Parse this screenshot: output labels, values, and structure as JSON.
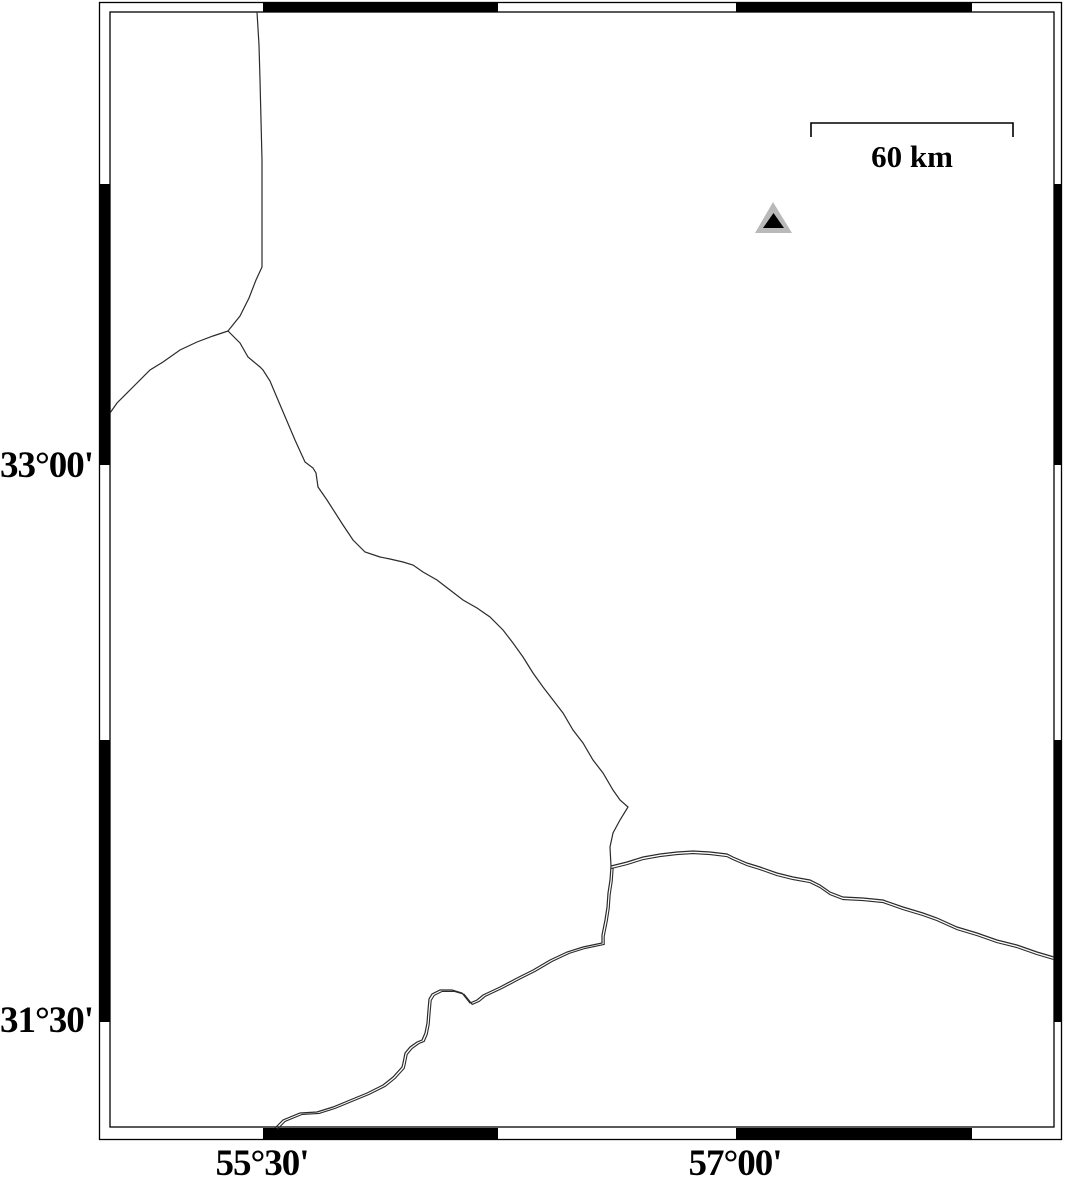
{
  "map": {
    "labels": {
      "latitude": [
        {
          "text": "33°00'",
          "y": 467
        },
        {
          "text": "31°30'",
          "y": 1022
        }
      ],
      "longitude": [
        {
          "text": "55°30'",
          "x": 262
        },
        {
          "text": "57°00'",
          "x": 735
        }
      ]
    },
    "scale_bar": {
      "label": "60 km",
      "x1": 811,
      "x2": 1013,
      "y": 123,
      "tick_drop": 14,
      "label_cx": 912
    },
    "colors": {
      "frame": "#000000",
      "line": "#2b2b2b",
      "marker_outer": "#b9b9b9",
      "marker_inner": "#000000",
      "background": "#ffffff"
    },
    "frame": {
      "outer": {
        "x": 99.5,
        "y": 2.5,
        "w": 962,
        "h": 1137
      },
      "inner": {
        "x": 110,
        "y": 12,
        "w": 944,
        "h": 1115
      },
      "top_band": {
        "y": 2,
        "h": 10,
        "black_spans": [
          [
            263,
            498
          ],
          [
            736,
            972
          ]
        ]
      },
      "bottom_band": {
        "y": 1128,
        "h": 12,
        "black_spans": [
          [
            263,
            498
          ],
          [
            736,
            972
          ]
        ]
      },
      "left_band": {
        "x": 99,
        "w": 11,
        "black_spans": [
          [
            184,
            465
          ],
          [
            740,
            1022
          ]
        ]
      },
      "right_band": {
        "x": 1054,
        "w": 8,
        "black_spans": [
          [
            184,
            465
          ],
          [
            740,
            1022
          ]
        ]
      }
    },
    "marker": {
      "shape": "triangle",
      "outer_points": [
        [
          773,
          202
        ],
        [
          755,
          233
        ],
        [
          792,
          233
        ]
      ],
      "inner_points": [
        [
          773.5,
          213
        ],
        [
          763,
          228
        ],
        [
          784,
          228
        ]
      ]
    },
    "lines": [
      {
        "name": "boundary-north",
        "double": false,
        "offset": [
          0,
          0
        ],
        "points": [
          [
            257,
            12
          ],
          [
            259,
            45
          ],
          [
            260,
            80
          ],
          [
            261,
            120
          ],
          [
            262,
            160
          ],
          [
            262,
            200
          ],
          [
            262,
            235
          ],
          [
            262,
            267
          ],
          [
            256,
            280
          ],
          [
            249,
            298
          ],
          [
            240,
            316
          ],
          [
            228,
            331
          ]
        ]
      },
      {
        "name": "boundary-west",
        "double": false,
        "offset": [
          0,
          0
        ],
        "points": [
          [
            228,
            331
          ],
          [
            213,
            336
          ],
          [
            197,
            342
          ],
          [
            180,
            350
          ],
          [
            163,
            362
          ],
          [
            150,
            370
          ],
          [
            133,
            387
          ],
          [
            117,
            403
          ],
          [
            110,
            413
          ]
        ]
      },
      {
        "name": "boundary-central",
        "double": false,
        "offset": [
          0,
          0
        ],
        "points": [
          [
            228,
            331
          ],
          [
            240,
            343
          ],
          [
            248,
            357
          ],
          [
            260,
            367
          ],
          [
            263,
            370
          ],
          [
            270,
            381
          ],
          [
            278,
            400
          ],
          [
            295,
            440
          ],
          [
            305,
            462
          ],
          [
            313,
            468
          ],
          [
            316,
            473
          ],
          [
            318,
            487
          ],
          [
            327,
            500
          ],
          [
            343,
            525
          ],
          [
            353,
            540
          ],
          [
            365,
            552
          ],
          [
            380,
            557
          ],
          [
            390,
            559
          ],
          [
            403,
            562
          ],
          [
            413,
            565
          ],
          [
            423,
            572
          ],
          [
            437,
            580
          ],
          [
            450,
            590
          ],
          [
            463,
            600
          ],
          [
            477,
            608
          ],
          [
            490,
            617
          ],
          [
            503,
            630
          ],
          [
            513,
            643
          ],
          [
            523,
            657
          ],
          [
            533,
            673
          ],
          [
            543,
            687
          ],
          [
            553,
            700
          ],
          [
            563,
            713
          ],
          [
            573,
            730
          ],
          [
            583,
            743
          ],
          [
            593,
            760
          ],
          [
            603,
            773
          ],
          [
            613,
            790
          ],
          [
            620,
            800
          ],
          [
            628,
            807
          ],
          [
            620,
            820
          ],
          [
            613,
            833
          ],
          [
            610,
            847
          ],
          [
            611,
            866
          ]
        ]
      },
      {
        "name": "road-east",
        "double": true,
        "offset": [
          0,
          2.6
        ],
        "points": [
          [
            611,
            866
          ],
          [
            627,
            862
          ],
          [
            643,
            857
          ],
          [
            660,
            854
          ],
          [
            677,
            852
          ],
          [
            693,
            851
          ],
          [
            710,
            852
          ],
          [
            727,
            854
          ],
          [
            733,
            857
          ],
          [
            747,
            863
          ],
          [
            760,
            867
          ],
          [
            777,
            873
          ],
          [
            793,
            877
          ],
          [
            810,
            880
          ],
          [
            820,
            885
          ],
          [
            830,
            892
          ],
          [
            843,
            897
          ],
          [
            863,
            898
          ],
          [
            883,
            900
          ],
          [
            903,
            907
          ],
          [
            923,
            913
          ],
          [
            937,
            918
          ],
          [
            957,
            927
          ],
          [
            977,
            933
          ],
          [
            997,
            940
          ],
          [
            1017,
            945
          ],
          [
            1037,
            952
          ],
          [
            1054,
            957
          ]
        ]
      },
      {
        "name": "road-southwest",
        "double": true,
        "offset": [
          2.2,
          1.4
        ],
        "points": [
          [
            611,
            866
          ],
          [
            610,
            880
          ],
          [
            608,
            893
          ],
          [
            607,
            907
          ],
          [
            605,
            920
          ],
          [
            602,
            935
          ],
          [
            602,
            943
          ],
          [
            583,
            947
          ],
          [
            567,
            952
          ],
          [
            550,
            960
          ],
          [
            533,
            970
          ],
          [
            517,
            978
          ],
          [
            500,
            987
          ],
          [
            483,
            995
          ],
          [
            477,
            1000
          ],
          [
            470,
            1003
          ],
          [
            462,
            993
          ],
          [
            452,
            990
          ],
          [
            440,
            990
          ],
          [
            432,
            994
          ],
          [
            429,
            999
          ],
          [
            428,
            1010
          ],
          [
            427,
            1023
          ],
          [
            425,
            1033
          ],
          [
            422,
            1040
          ],
          [
            417,
            1042
          ],
          [
            410,
            1047
          ],
          [
            405,
            1053
          ],
          [
            403,
            1063
          ],
          [
            402,
            1067
          ],
          [
            393,
            1077
          ],
          [
            383,
            1085
          ],
          [
            367,
            1093
          ],
          [
            350,
            1100
          ],
          [
            333,
            1107
          ],
          [
            317,
            1112
          ],
          [
            300,
            1113
          ],
          [
            283,
            1120
          ],
          [
            275,
            1128
          ]
        ]
      }
    ]
  }
}
